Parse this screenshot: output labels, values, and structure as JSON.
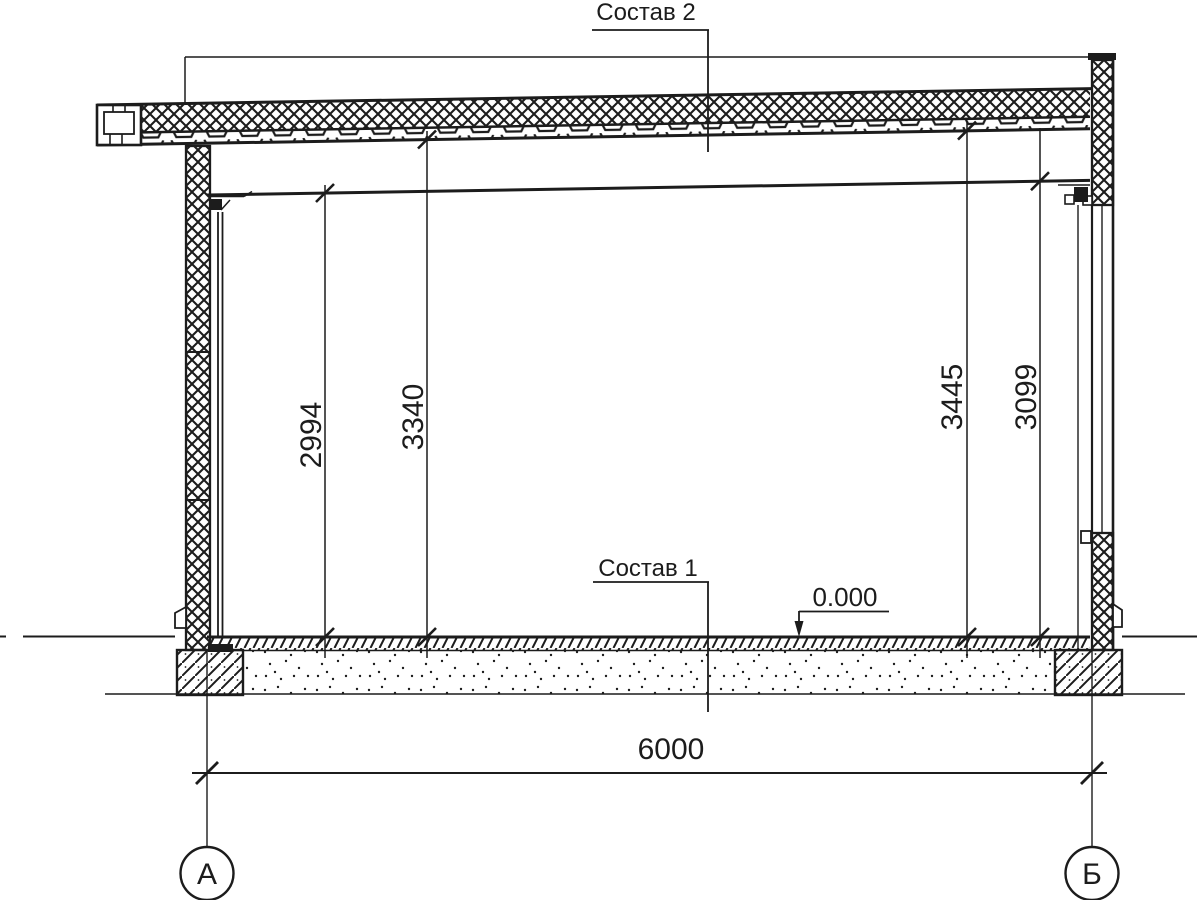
{
  "drawing": {
    "type": "building-section",
    "labels": {
      "roof_composition": "Состав 2",
      "floor_composition": "Состав 1",
      "elevation_mark": "0.000"
    },
    "dimensions": {
      "interior_height_left": "2994",
      "clear_height_left": "3340",
      "clear_height_right": "3445",
      "interior_height_right": "3099",
      "span": "6000"
    },
    "axes": {
      "left_label": "А",
      "right_label": "Б"
    },
    "colors": {
      "line": "#1c1c1c",
      "background": "#ffffff"
    }
  }
}
